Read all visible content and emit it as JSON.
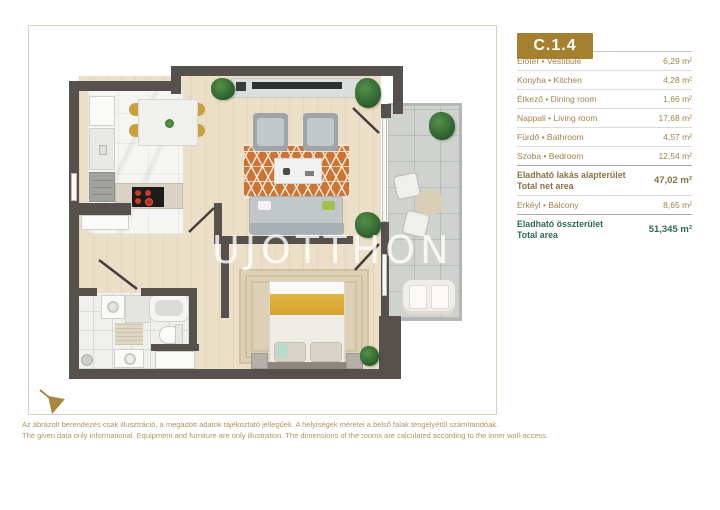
{
  "unit": {
    "code": "C.1.4"
  },
  "table": {
    "rows": [
      {
        "label": "Előtér • Vestibule",
        "value": "6,29 m²"
      },
      {
        "label": "Konyha • Kitchen",
        "value": "4,28 m²"
      },
      {
        "label": "Étkező • Dining room",
        "value": "1,66 m²"
      },
      {
        "label": "Nappali • Living room",
        "value": "17,68 m²"
      },
      {
        "label": "Fürdő • Bathroom",
        "value": "4,57 m²"
      },
      {
        "label": "Szoba • Bedroom",
        "value": "12,54 m²"
      }
    ],
    "net_area": {
      "label_hu": "Eladható lakás alapterület",
      "label_en": "Total net area",
      "value": "47,02 m²"
    },
    "balcony_row": {
      "label": "Erkéyl • Balcony",
      "value": "8,65 m²"
    },
    "total_area": {
      "label_hu": "Eladható összterület",
      "label_en": "Total area",
      "value": "51,345 m²"
    }
  },
  "watermark": {
    "left": "UJOTTHON",
    "right": "HU"
  },
  "disclaimer": {
    "hu": "Az ábrázolt berendezés csak illusztráció, a megadott adatok tájékoztató jellegűek. A helyiségek méretei a belső falak tengelyétől számítandóak.",
    "en": "The given data only informational. Equipment and furniture are only illustration. The dimensions of the rooms are calculated according to the inner wall-access."
  },
  "colors": {
    "badge_gold": "#a5802f",
    "text_gold": "#a3824c",
    "total_green": "#2d6b51",
    "wall_dark": "#57514e",
    "rug_orange": "#cd7434",
    "frame_border": "#d5d2bd"
  }
}
